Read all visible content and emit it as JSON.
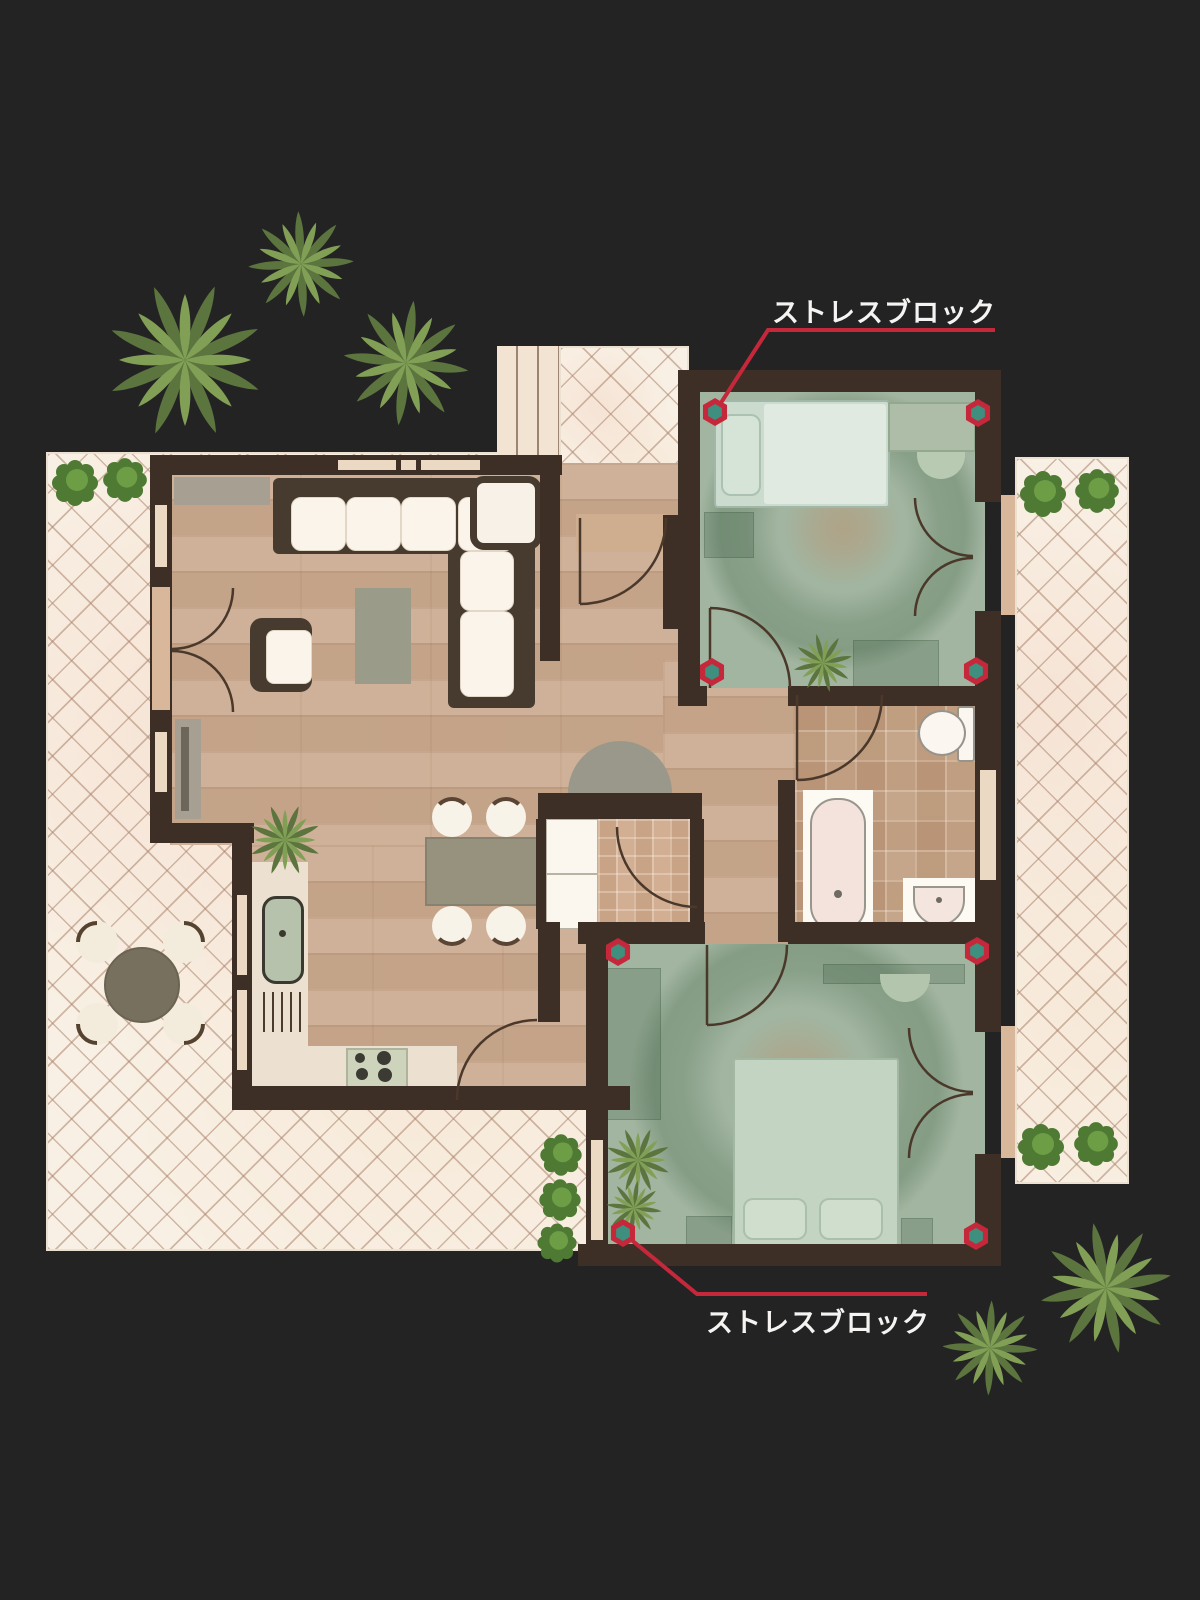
{
  "diagram": {
    "type": "annotated-floor-plan",
    "background_color": "#232323",
    "annotations": {
      "top_label": "ストレスブロック",
      "bottom_label": "ストレスブロック"
    },
    "stress_block_markers": {
      "shape": "hexagon",
      "ring_color": "#c5273b",
      "center_color": "#3f8f7f",
      "count": 8,
      "positions": [
        [
          715,
          412
        ],
        [
          978,
          413
        ],
        [
          712,
          672
        ],
        [
          976,
          671
        ],
        [
          618,
          952
        ],
        [
          977,
          951
        ],
        [
          623,
          1233
        ],
        [
          976,
          1236
        ]
      ]
    },
    "colors": {
      "wall": "#3e2f26",
      "leader": "#c5273b",
      "label-color": "#f5f4f2",
      "marker-ring": "#c5273b",
      "marker-center": "#3f8f7f"
    }
  }
}
